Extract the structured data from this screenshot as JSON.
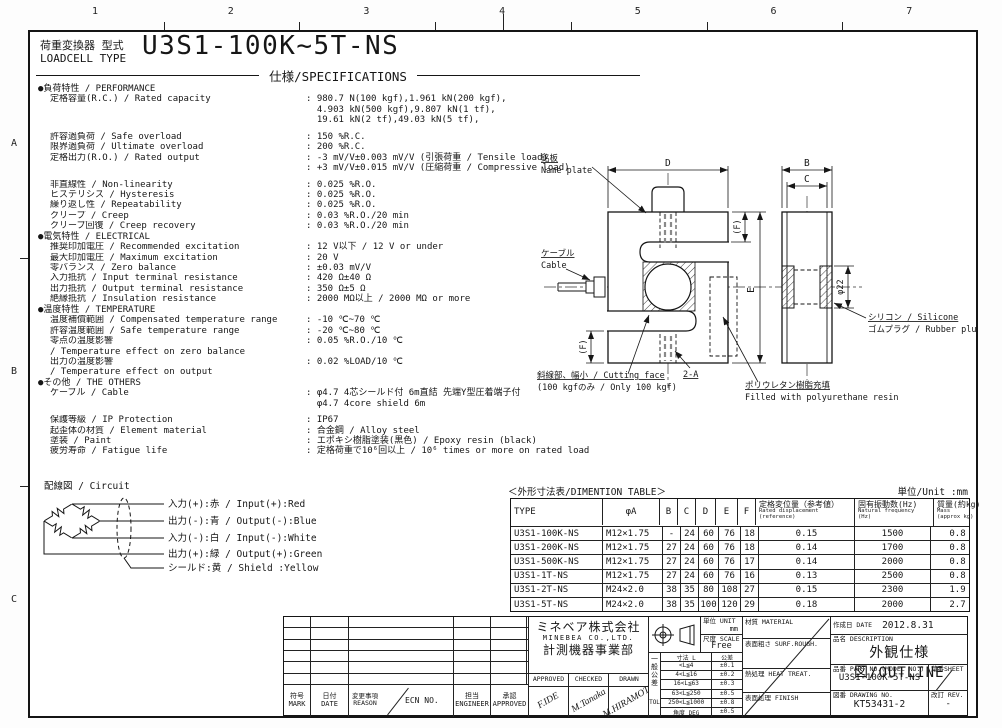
{
  "header": {
    "type_label_jp": "荷重変換器 型式",
    "type_label_en": "LOADCELL TYPE",
    "model": "U3S1-100K~5T-NS",
    "spec_title": "仕様/SPECIFICATIONS"
  },
  "ruler": {
    "cols": [
      "1",
      "2",
      "3",
      "4",
      "5",
      "6",
      "7"
    ],
    "rows": [
      "A",
      "B",
      "C"
    ]
  },
  "specs": {
    "sections": [
      {
        "header": "●負荷特性 / PERFORMANCE",
        "rows": [
          {
            "l": "定格容量(R.C.) / Rated capacity",
            "v": "980.7 N(100 kgf),1.961 kN(200 kgf),",
            "c": 1
          },
          {
            "l": "",
            "v": "4.903 kN(500 kgf),9.807 kN(1 tf),",
            "c": 0
          },
          {
            "l": "",
            "v": "19.61 kN(2 tf),49.03 kN(5 tf),",
            "c": 0
          },
          {
            "sp": 1
          },
          {
            "l": "許容過負荷 / Safe overload",
            "v": "150 %R.C.",
            "c": 1
          },
          {
            "l": "限界過負荷 / Ultimate overload",
            "v": "200 %R.C.",
            "c": 1
          },
          {
            "l": "定格出力(R.O.) / Rated output",
            "v": "-3 mV/V±0.003 mV/V (引張荷重 / Tensile load)",
            "c": 1
          },
          {
            "l": "",
            "v": "+3 mV/V±0.015 mV/V (圧縮荷重 / Compressive load)",
            "c": 1
          },
          {
            "sp": 1
          },
          {
            "l": "非直線性 / Non-linearity",
            "v": "0.025 %R.O.",
            "c": 1
          },
          {
            "l": "ヒステリシス / Hysteresis",
            "v": "0.025 %R.O.",
            "c": 1
          },
          {
            "l": "繰り返し性 / Repeatability",
            "v": "0.025 %R.O.",
            "c": 1
          },
          {
            "l": "クリープ / Creep",
            "v": "0.03 %R.O./20 min",
            "c": 1
          },
          {
            "l": "クリープ回復 / Creep recovery",
            "v": "0.03 %R.O./20 min",
            "c": 1
          }
        ]
      },
      {
        "header": "●電気特性 / ELECTRICAL",
        "rows": [
          {
            "l": "推奨印加電圧 / Recommended excitation",
            "v": "12 V以下 / 12 V or under",
            "c": 1
          },
          {
            "l": "最大印加電圧 / Maximum excitation",
            "v": "20 V",
            "c": 1
          },
          {
            "l": "零バランス / Zero balance",
            "v": "±0.03 mV/V",
            "c": 1
          },
          {
            "l": "入力抵抗 / Input terminal resistance",
            "v": "420 Ω±40 Ω",
            "c": 1
          },
          {
            "l": "出力抵抗 / Output terminal resistance",
            "v": "350 Ω±5 Ω",
            "c": 1
          },
          {
            "l": "絶縁抵抗 / Insulation resistance",
            "v": "2000 MΩ以上 / 2000 MΩ or more",
            "c": 1
          }
        ]
      },
      {
        "header": "●温度特性 / TEMPERATURE",
        "rows": [
          {
            "l": "温度補償範囲 / Compensated temperature range",
            "v": "-10 ℃~70 ℃",
            "c": 1
          },
          {
            "l": "許容温度範囲 / Safe temperature range",
            "v": "-20 ℃~80 ℃",
            "c": 1
          },
          {
            "l": "零点の温度影響",
            "v": "0.05 %R.O./10 ℃",
            "c": 1
          },
          {
            "l": "/ Temperature effect on zero balance",
            "v": null
          },
          {
            "l": "出力の温度影響",
            "v": "0.02 %LOAD/10 ℃",
            "c": 1
          },
          {
            "l": "/ Temperature effect on output",
            "v": null
          }
        ]
      },
      {
        "header": "●その他 / THE OTHERS",
        "rows": [
          {
            "l": "ケーブル / Cable",
            "v": "φ4.7 4芯シールド付 6m直結 先端Y型圧着端子付",
            "c": 1
          },
          {
            "l": "",
            "v": "φ4.7 4core shield 6m",
            "c": 0
          },
          {
            "sp": 1
          },
          {
            "l": "保護等級 / IP Protection",
            "v": "IP67",
            "c": 1
          },
          {
            "l": "起歪体の材質 / Element material",
            "v": "合金鋼 / Alloy steel",
            "c": 1
          },
          {
            "l": "塗装 / Paint",
            "v": "エポキシ樹脂塗装(黒色) / Epoxy resin (black)",
            "c": 1
          },
          {
            "l": "疲労寿命 / Fatigue life",
            "v": "定格荷重で10⁶回以上 / 10⁶ times or more on rated load",
            "c": 1
          }
        ]
      }
    ]
  },
  "circuit": {
    "label": "配線図 / Circuit",
    "wires": [
      "入力(+):赤 / Input(+):Red",
      "出力(-):青 / Output(-):Blue",
      "入力(-):白 / Input(-):White",
      "出力(+):緑 / Output(+):Green",
      "シールド:黄 / Shield :Yellow"
    ]
  },
  "drawing": {
    "dims": {
      "d": "D",
      "e": "E",
      "b": "B",
      "c": "C",
      "f_top": "(F)",
      "f_bot": "(F)",
      "phi": "φ22",
      "bolt": "2-A"
    },
    "callouts": {
      "name_plate_jp": "銘板",
      "name_plate_en": "Name plate",
      "cable_jp": "ケーブル",
      "cable_en": "Cable",
      "cutting_jp": "斜線部、幅小 / Cutting face",
      "cutting_en": "(100 kgfのみ / Only 100 kgf)",
      "resin_jp": "ポリウレタン樹脂充填",
      "resin_en": "Filled with polyurethane resin",
      "silicone_jp": "シリコン / Silicone",
      "silicone_en": "ゴムプラグ / Rubber plug"
    }
  },
  "dimension_table": {
    "title": "＜外形寸法表/DIMENTION TABLE＞",
    "unit_note": "単位/Unit :mm",
    "columns": [
      {
        "jp": "TYPE"
      },
      {
        "jp": "φA"
      },
      {
        "jp": "B"
      },
      {
        "jp": "C"
      },
      {
        "jp": "D"
      },
      {
        "jp": "E"
      },
      {
        "jp": "F"
      },
      {
        "jp": "定格変位量（参考値）",
        "en": [
          "Rated displacement",
          "(reference)"
        ]
      },
      {
        "jp": "固有振動数(Hz)",
        "en": [
          "Natural frequency",
          "(Hz)"
        ]
      },
      {
        "jp": "質量(約kg)",
        "en": [
          "Mass",
          "(approx kg)"
        ]
      }
    ],
    "rows": [
      [
        "U3S1-100K-NS",
        "M12×1.75",
        "-",
        "24",
        "60",
        "76",
        "18",
        "0.15",
        "1500",
        "0.8"
      ],
      [
        "U3S1-200K-NS",
        "M12×1.75",
        "27",
        "24",
        "60",
        "76",
        "18",
        "0.14",
        "1700",
        "0.8"
      ],
      [
        "U3S1-500K-NS",
        "M12×1.75",
        "27",
        "24",
        "60",
        "76",
        "17",
        "0.14",
        "2000",
        "0.8"
      ],
      [
        "U3S1-1T-NS",
        "M12×1.75",
        "27",
        "24",
        "60",
        "76",
        "16",
        "0.13",
        "2500",
        "0.8"
      ],
      [
        "U3S1-2T-NS",
        "M24×2.0",
        "38",
        "35",
        "80",
        "108",
        "27",
        "0.15",
        "2300",
        "1.9"
      ],
      [
        "U3S1-5T-NS",
        "M24×2.0",
        "38",
        "35",
        "100",
        "120",
        "29",
        "0.18",
        "2000",
        "2.7"
      ]
    ]
  },
  "title_block": {
    "revision": {
      "mark_jp": "符号",
      "mark_en": "MARK",
      "date_jp": "日付",
      "date_en": "DATE",
      "reason_jp": "変更事項",
      "reason_en": "REASON",
      "ecn": "ECN NO.",
      "engineer_jp": "担当",
      "engineer_en": "ENGINEER",
      "approved_jp": "承認",
      "approved_en": "APPROVED"
    },
    "company": {
      "name_jp": "ミネベア株式会社",
      "name_en": "MINEBEA CO.,LTD.",
      "division": "計測機器事業部",
      "sig_headers": [
        "APPROVED",
        "CHECKED",
        "DRAWN"
      ],
      "signatures": [
        "F.IDE",
        "M.Tanaka",
        "M.HIRAMOTO"
      ]
    },
    "unit": {
      "label": "単位 UNIT",
      "value": "mm"
    },
    "scale": {
      "label": "尺度 SCALE",
      "value": "Free"
    },
    "tolerance": {
      "side_jp": "一般公差",
      "side_en": "TOL",
      "header": [
        "寸法 L",
        "公差"
      ],
      "rows": [
        [
          "<L≦4",
          "±0.1"
        ],
        [
          "4<L≦16",
          "±0.2"
        ],
        [
          "16<L≦63",
          "±0.3"
        ],
        [
          "63<L≦250",
          "±0.5"
        ],
        [
          "250<L≦1000",
          "±0.8"
        ],
        [
          "角度 DEG",
          "±0.5"
        ]
      ]
    },
    "material": {
      "rows": [
        "材質 MATERIAL",
        "表面粗さ SURF.ROUGH.",
        "熱処理 HEAT TREAT.",
        "表面処理 FINISH"
      ]
    },
    "info": {
      "date_label": "作成日 DATE",
      "date_value": "2012.8.31",
      "desc_label": "品名 DESCRIPTION",
      "desc_value": "外観仕様図/OUTLINE",
      "part_label": "品番 PART NO.(MODEL NO.)",
      "part_value": "U3S1-100K~5T-NS",
      "sheet_label": "葉番SHEET",
      "drawing_label": "図番 DRAWING NO.",
      "drawing_value": "KT53431-2",
      "rev_label": "改訂 REV.",
      "rev_value": "-"
    }
  }
}
